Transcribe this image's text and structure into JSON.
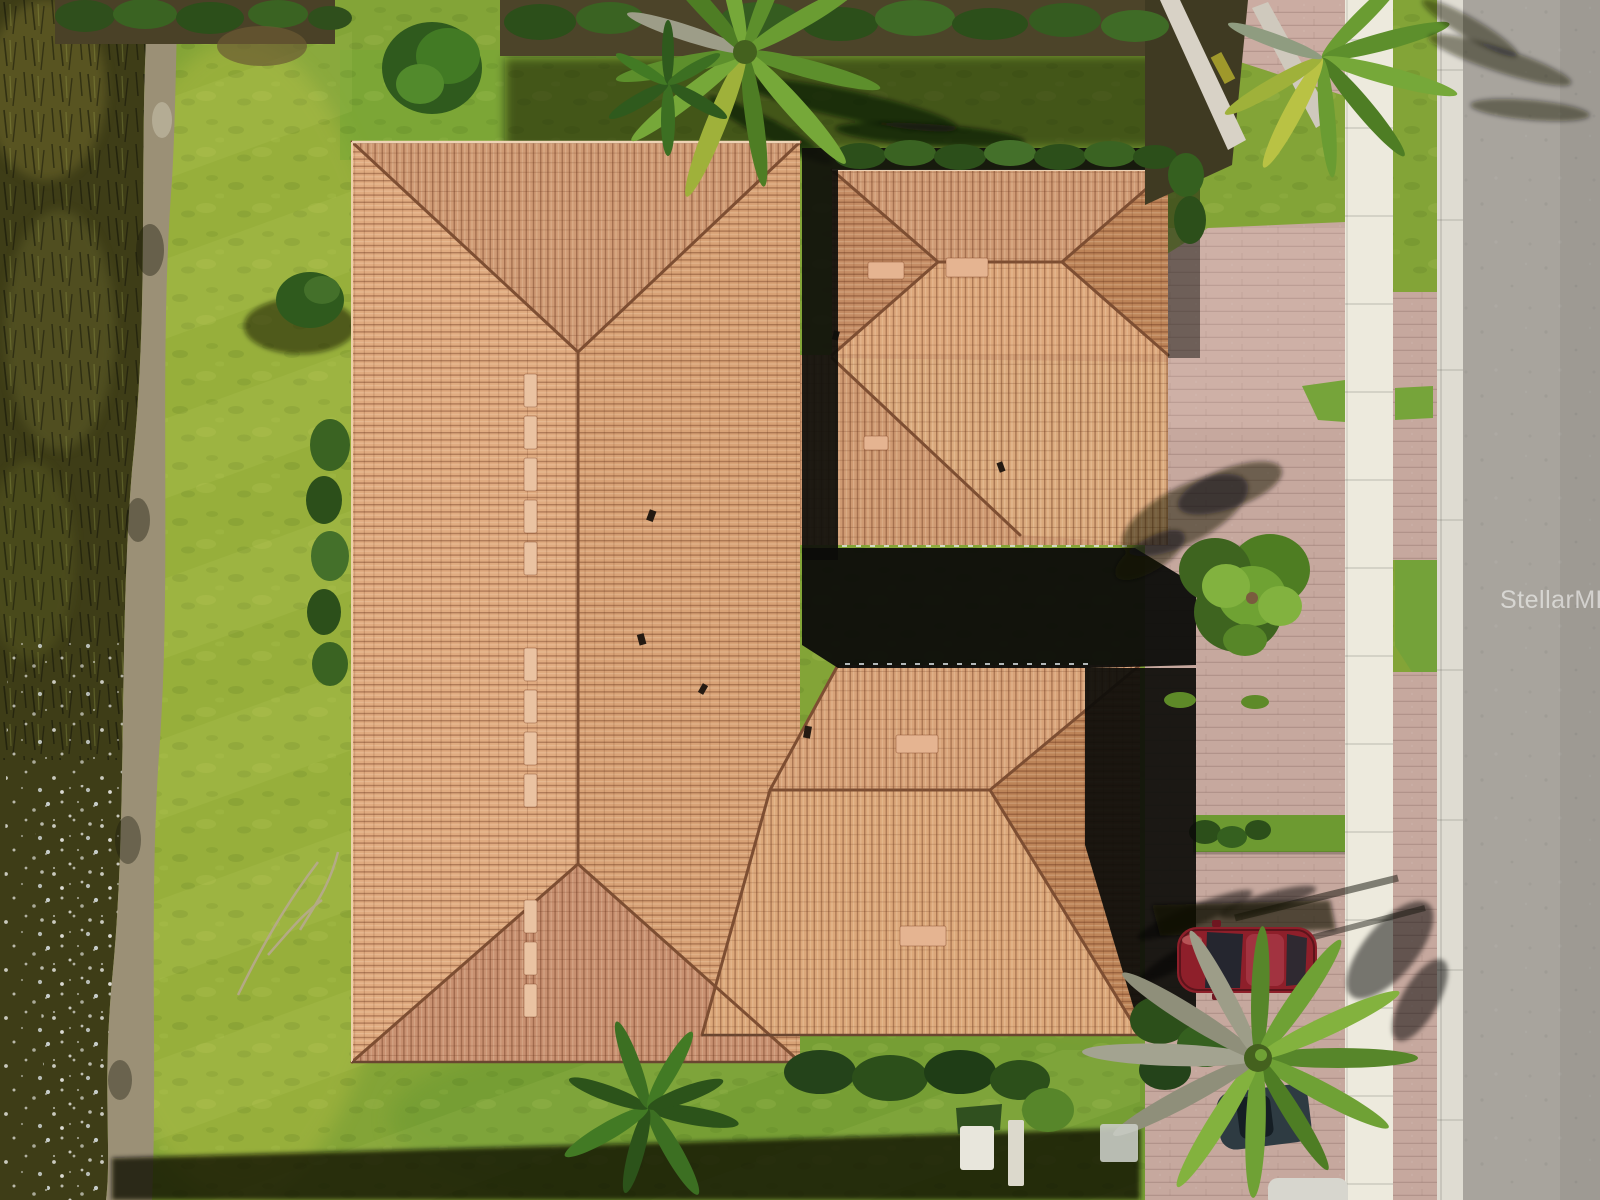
{
  "image": {
    "kind": "aerial-drone-photo",
    "subject": "top-down view of a large Mediterranean-style home with terracotta barrel-tile hip roof, paver driveway, sidewalk and street on the right, lawn and pond bank on the left",
    "orientation": "top-down"
  },
  "watermark": {
    "text": "StellarMLS",
    "color": "#ffffff",
    "opacity": 0.55
  },
  "palette": {
    "roof_tile_light": "#dfac80",
    "roof_tile_mid": "#cf9a72",
    "roof_tile_dark": "#bd8458",
    "roof_ridge": "#7d4e32",
    "deep_shadow": "#0d0d0a",
    "grass": "#83a437",
    "grass_light": "#a9b83f",
    "grass_dark": "#5e8a28",
    "pond_water": "#3e3d17",
    "pond_bank": "#9b9076",
    "driveway_paver": "#c6a89e",
    "sidewalk": "#edeadd",
    "curb": "#dfdcd2",
    "road": "#a8a49d",
    "hedge": "#2f4f1c",
    "tree_canopy": "#6fa233",
    "palm_green": "#6fa135",
    "palm_dead": "#9d9d88",
    "car_red": "#8e1f2a",
    "car_dark": "#2e3b42",
    "utility_box": "#e8e6dc"
  },
  "scene": {
    "elements": [
      "pond-water",
      "pond-bank",
      "lawn",
      "landscape-beds",
      "main-roof-wing",
      "garage-roof-wing",
      "mid-east-roof",
      "southeast-roof-wing",
      "courtyard-shadow",
      "roof-vents",
      "driveway-pavers",
      "grass-median",
      "sidewalk",
      "curb",
      "road",
      "street-tree",
      "palm-cluster-top",
      "palm-cluster-top-right",
      "palm-cluster-bottom",
      "tropical-plant",
      "red-car",
      "dark-car",
      "utility-boxes",
      "fallen-branch",
      "stellar-mls-watermark"
    ]
  }
}
